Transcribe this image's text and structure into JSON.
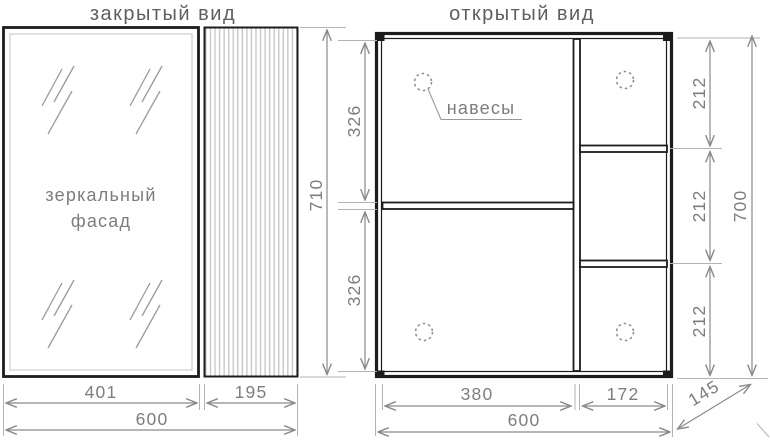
{
  "colors": {
    "frame": "#1c1c1c",
    "dim_line": "#8a8a8a",
    "ext_line": "#b3b3b3",
    "text_title": "#5f5f5f",
    "text_dim": "#7d7d7d",
    "stripe": "#c8c8c8",
    "hatch": "#9a9a9a",
    "inner_border": "#c4c4c4",
    "hole": "#8f8f8f",
    "background": "#ffffff"
  },
  "closed_view": {
    "title": "закрытый вид",
    "facade_label_line1": "зеркальный",
    "facade_label_line2": "фасад",
    "dim_door_width": "401",
    "dim_panel_width": "195",
    "dim_total_width": "600",
    "dim_height": "710"
  },
  "open_view": {
    "title": "открытый вид",
    "hangers_label": "навесы",
    "dim_section_top": "326",
    "dim_section_bottom": "326",
    "dim_shelf_1": "212",
    "dim_shelf_2": "212",
    "dim_shelf_3": "212",
    "dim_height": "700",
    "dim_left_width": "380",
    "dim_right_width": "172",
    "dim_total_width": "600",
    "dim_depth": "145"
  }
}
